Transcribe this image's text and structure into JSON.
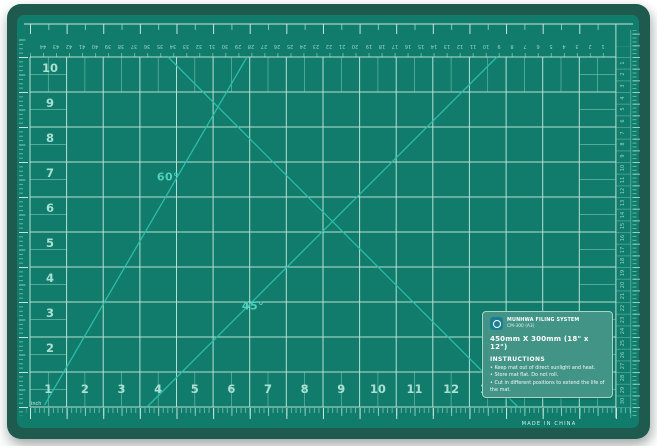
{
  "mat": {
    "angle_labels": {
      "sixty": "60°",
      "forty_five": "45°"
    },
    "left_numbers": [
      "10",
      "9",
      "8",
      "7",
      "6",
      "5",
      "4",
      "3",
      "2"
    ],
    "bottom_numbers": [
      "1",
      "2",
      "3",
      "4",
      "5",
      "6",
      "7",
      "8",
      "9",
      "10",
      "11",
      "12",
      "13",
      "14",
      "15",
      "16"
    ],
    "top_cm_numbers": [
      "44",
      "43",
      "42",
      "41",
      "40",
      "39",
      "38",
      "37",
      "36",
      "35",
      "34",
      "33",
      "32",
      "31",
      "30",
      "29",
      "28",
      "27",
      "26",
      "25",
      "24",
      "23",
      "22",
      "21",
      "20",
      "19",
      "18",
      "17",
      "16",
      "15",
      "14",
      "13",
      "12",
      "11",
      "10",
      "9",
      "8",
      "7",
      "6",
      "5",
      "4",
      "3",
      "2",
      "1"
    ],
    "right_cm_numbers": [
      "1",
      "2",
      "3",
      "4",
      "5",
      "6",
      "7",
      "8",
      "9",
      "10",
      "11",
      "12",
      "13",
      "14",
      "15",
      "16",
      "17",
      "18",
      "19",
      "20",
      "21",
      "22",
      "23",
      "24",
      "25",
      "26",
      "27",
      "28",
      "29",
      "30"
    ],
    "inch_label": "inch",
    "made_in": "MADE IN CHINA",
    "label": {
      "brand_line1": "MUNHWA FILING SYSTEM",
      "brand_line2": "CM-300 (A3)",
      "size_line": "450mm X 300mm (18\" x 12\")",
      "instructions_title": "INSTRUCTIONS",
      "instructions": [
        "Keep mat out of direct sunlight and heat.",
        "Store mat flat. Do not roll.",
        "Cut in different positions to extend the life of the mat."
      ]
    },
    "colors": {
      "mat_border": "#1e5a4d",
      "mat_surface": "#117c6b",
      "grid_major_line": "#c6e7de",
      "grid_fine_line": "#84cfc0",
      "diagonal_line": "#2cc0ae",
      "angle_label": "#4fd2bf",
      "grid_numbers": "#a9e0d3",
      "tiny_numbers": "#96d6c7",
      "label_background": "#419486",
      "logo_badge": "#1b7e93"
    }
  }
}
